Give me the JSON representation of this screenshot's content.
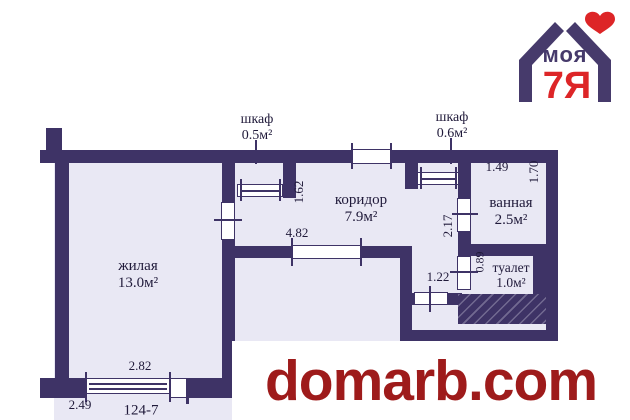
{
  "watermark": {
    "text": "domarb.com",
    "color": "#9e1b1b"
  },
  "logo": {
    "word_top": "моя",
    "word_main": "7Я",
    "purple": "#463a6b",
    "red": "#dd2527",
    "heart_icon": "heart"
  },
  "plan": {
    "apartment_number": "124-7",
    "colors": {
      "wall": "#3e3366",
      "floor": "#e9e8f4",
      "text": "#201a3a"
    },
    "rooms": {
      "zhilaya": {
        "name": "жилая",
        "area": "13.0м²"
      },
      "koridor": {
        "name": "коридор",
        "area": "7.9м²"
      },
      "vannaya": {
        "name": "ванная",
        "area": "2.5м²"
      },
      "tualet": {
        "name": "туалет",
        "area": "1.0м²"
      },
      "shkaf1": {
        "name": "шкаф",
        "area": "0.5м²"
      },
      "shkaf2": {
        "name": "шкаф",
        "area": "0.6м²"
      }
    },
    "dimensions": {
      "zhilaya_width": "2.82",
      "zhilaya_bottom": "2.49",
      "koridor_width": "4.82",
      "koridor_left_height": "1.62",
      "koridor_right_height": "2.17",
      "lower_door_width": "1.22",
      "vannaya_width": "1.49",
      "vannaya_height": "1.70",
      "tualet_height": "0.89"
    }
  }
}
